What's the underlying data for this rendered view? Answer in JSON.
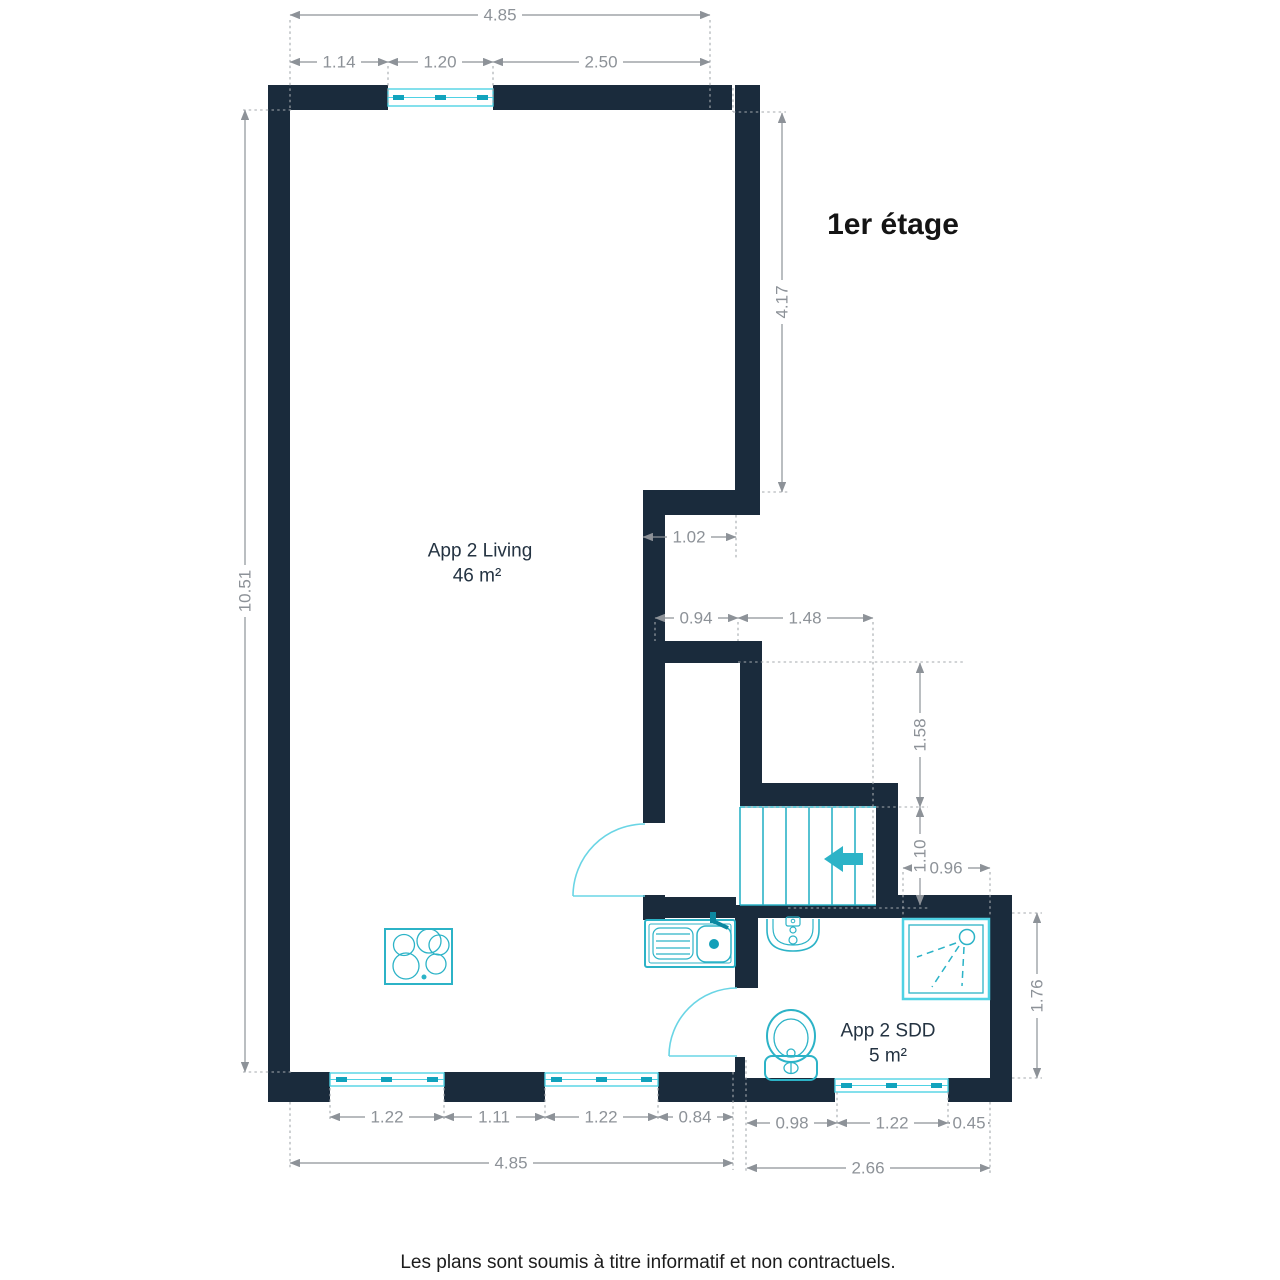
{
  "title": "1er étage",
  "rooms": {
    "living": {
      "name": "App 2 Living",
      "area": "46 m²"
    },
    "sdd": {
      "name": "App 2 SDD",
      "area": "5 m²"
    }
  },
  "dims": {
    "top_total": "4.85",
    "top_a": "1.14",
    "top_b": "1.20",
    "top_c": "2.50",
    "left_total": "10.51",
    "upper_right": "4.17",
    "hall": "1.02",
    "mid_a": "0.94",
    "mid_b": "1.48",
    "stair_a": "1.58",
    "stair_b": "1.10",
    "shower": "0.96",
    "sdd_height": "1.76",
    "bot_a": "1.22",
    "bot_b": "1.11",
    "bot_c": "1.22",
    "bot_d": "0.84",
    "bot_total": "4.85",
    "sdd_a": "0.98",
    "sdd_b": "1.22",
    "sdd_c": "0.45",
    "sdd_total": "2.66"
  },
  "footer": "Les plans sont soumis à titre informatif et non contractuels.",
  "colors": {
    "wall": "#1a2b3c",
    "fixture": "#2cb3c7",
    "window": "#4fd2e4",
    "dimension": "#8d9298",
    "text": "#1c1c1c"
  }
}
